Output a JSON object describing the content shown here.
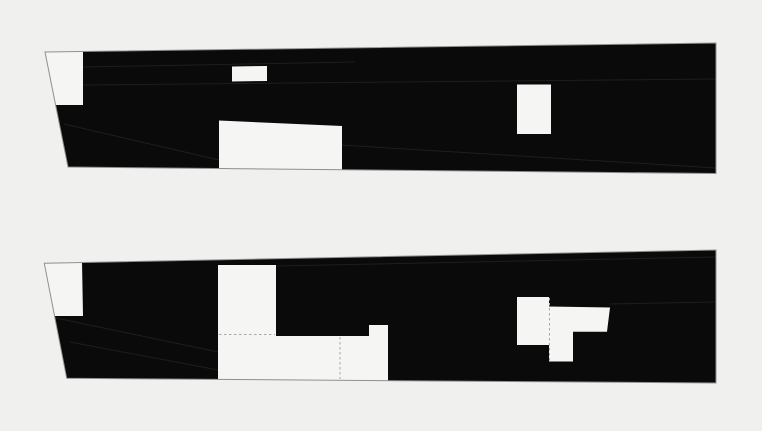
{
  "figure": {
    "description_name": "two-black-elevation-diagrams",
    "width": 762,
    "height": 431,
    "colors": {
      "background": "#f0f0ef",
      "panel_fill": "#0a0a0a",
      "cutout_fill": "#f5f5f4",
      "outline_stroke": "#8f8f8f",
      "dash_stroke": "#a8a8a8",
      "seam_stroke": "#1e1e1e"
    },
    "panels": [
      {
        "name": "elevation-top",
        "outline": "45,52 716,43 716,173.5 68,167",
        "cutouts": [
          {
            "name": "opening-top-left-trapezoid",
            "points": "45,52 83,51.4 83,105 55.6,105"
          },
          {
            "name": "opening-small-rect",
            "points": "232,66.5 267,66 267,81 232,81.5"
          },
          {
            "name": "opening-large-rect-bottom",
            "points": "219,120.5 342,126 342,169.6 219,168.4"
          },
          {
            "name": "opening-right-rect",
            "points": "517,84.5 551,84.5 551,134 517,134"
          }
        ],
        "dashes": [],
        "seams": [
          {
            "x1": 83,
            "y1": 67,
            "x2": 355,
            "y2": 62
          },
          {
            "x1": 83,
            "y1": 85,
            "x2": 716,
            "y2": 79
          },
          {
            "x1": 64,
            "y1": 124,
            "x2": 219,
            "y2": 160
          },
          {
            "x1": 341,
            "y1": 145,
            "x2": 716,
            "y2": 168
          }
        ]
      },
      {
        "name": "elevation-bottom",
        "outline": "44.3,263.3 716,250 716,383 66.7,378.3",
        "cutouts": [
          {
            "name": "opening-bottom-left-trapezoid",
            "points": "44.3,263.3 82,261.8 83,316 54.8,316"
          },
          {
            "name": "opening-middle-l-shape",
            "points": "218,265 276,265 276,336 369,336 369,325 388,325 388,380.8 218,379.4"
          },
          {
            "name": "opening-right-cross-shape",
            "points": "517,297 549,297 549,306.5 610,307.5 607,331.7 573,331.7 573,361.5 549,361.5 549,345 517,345"
          }
        ],
        "dashes": [
          {
            "x1": 219,
            "y1": 334.5,
            "x2": 275,
            "y2": 334.5
          },
          {
            "x1": 340,
            "y1": 337,
            "x2": 340,
            "y2": 379
          },
          {
            "x1": 549.5,
            "y1": 298,
            "x2": 549.5,
            "y2": 361
          }
        ],
        "seams": [
          {
            "x1": 276,
            "y1": 266,
            "x2": 716,
            "y2": 257
          },
          {
            "x1": 610,
            "y1": 304,
            "x2": 716,
            "y2": 302
          },
          {
            "x1": 56,
            "y1": 318,
            "x2": 218,
            "y2": 352
          },
          {
            "x1": 70,
            "y1": 342,
            "x2": 218,
            "y2": 370
          }
        ]
      }
    ]
  }
}
